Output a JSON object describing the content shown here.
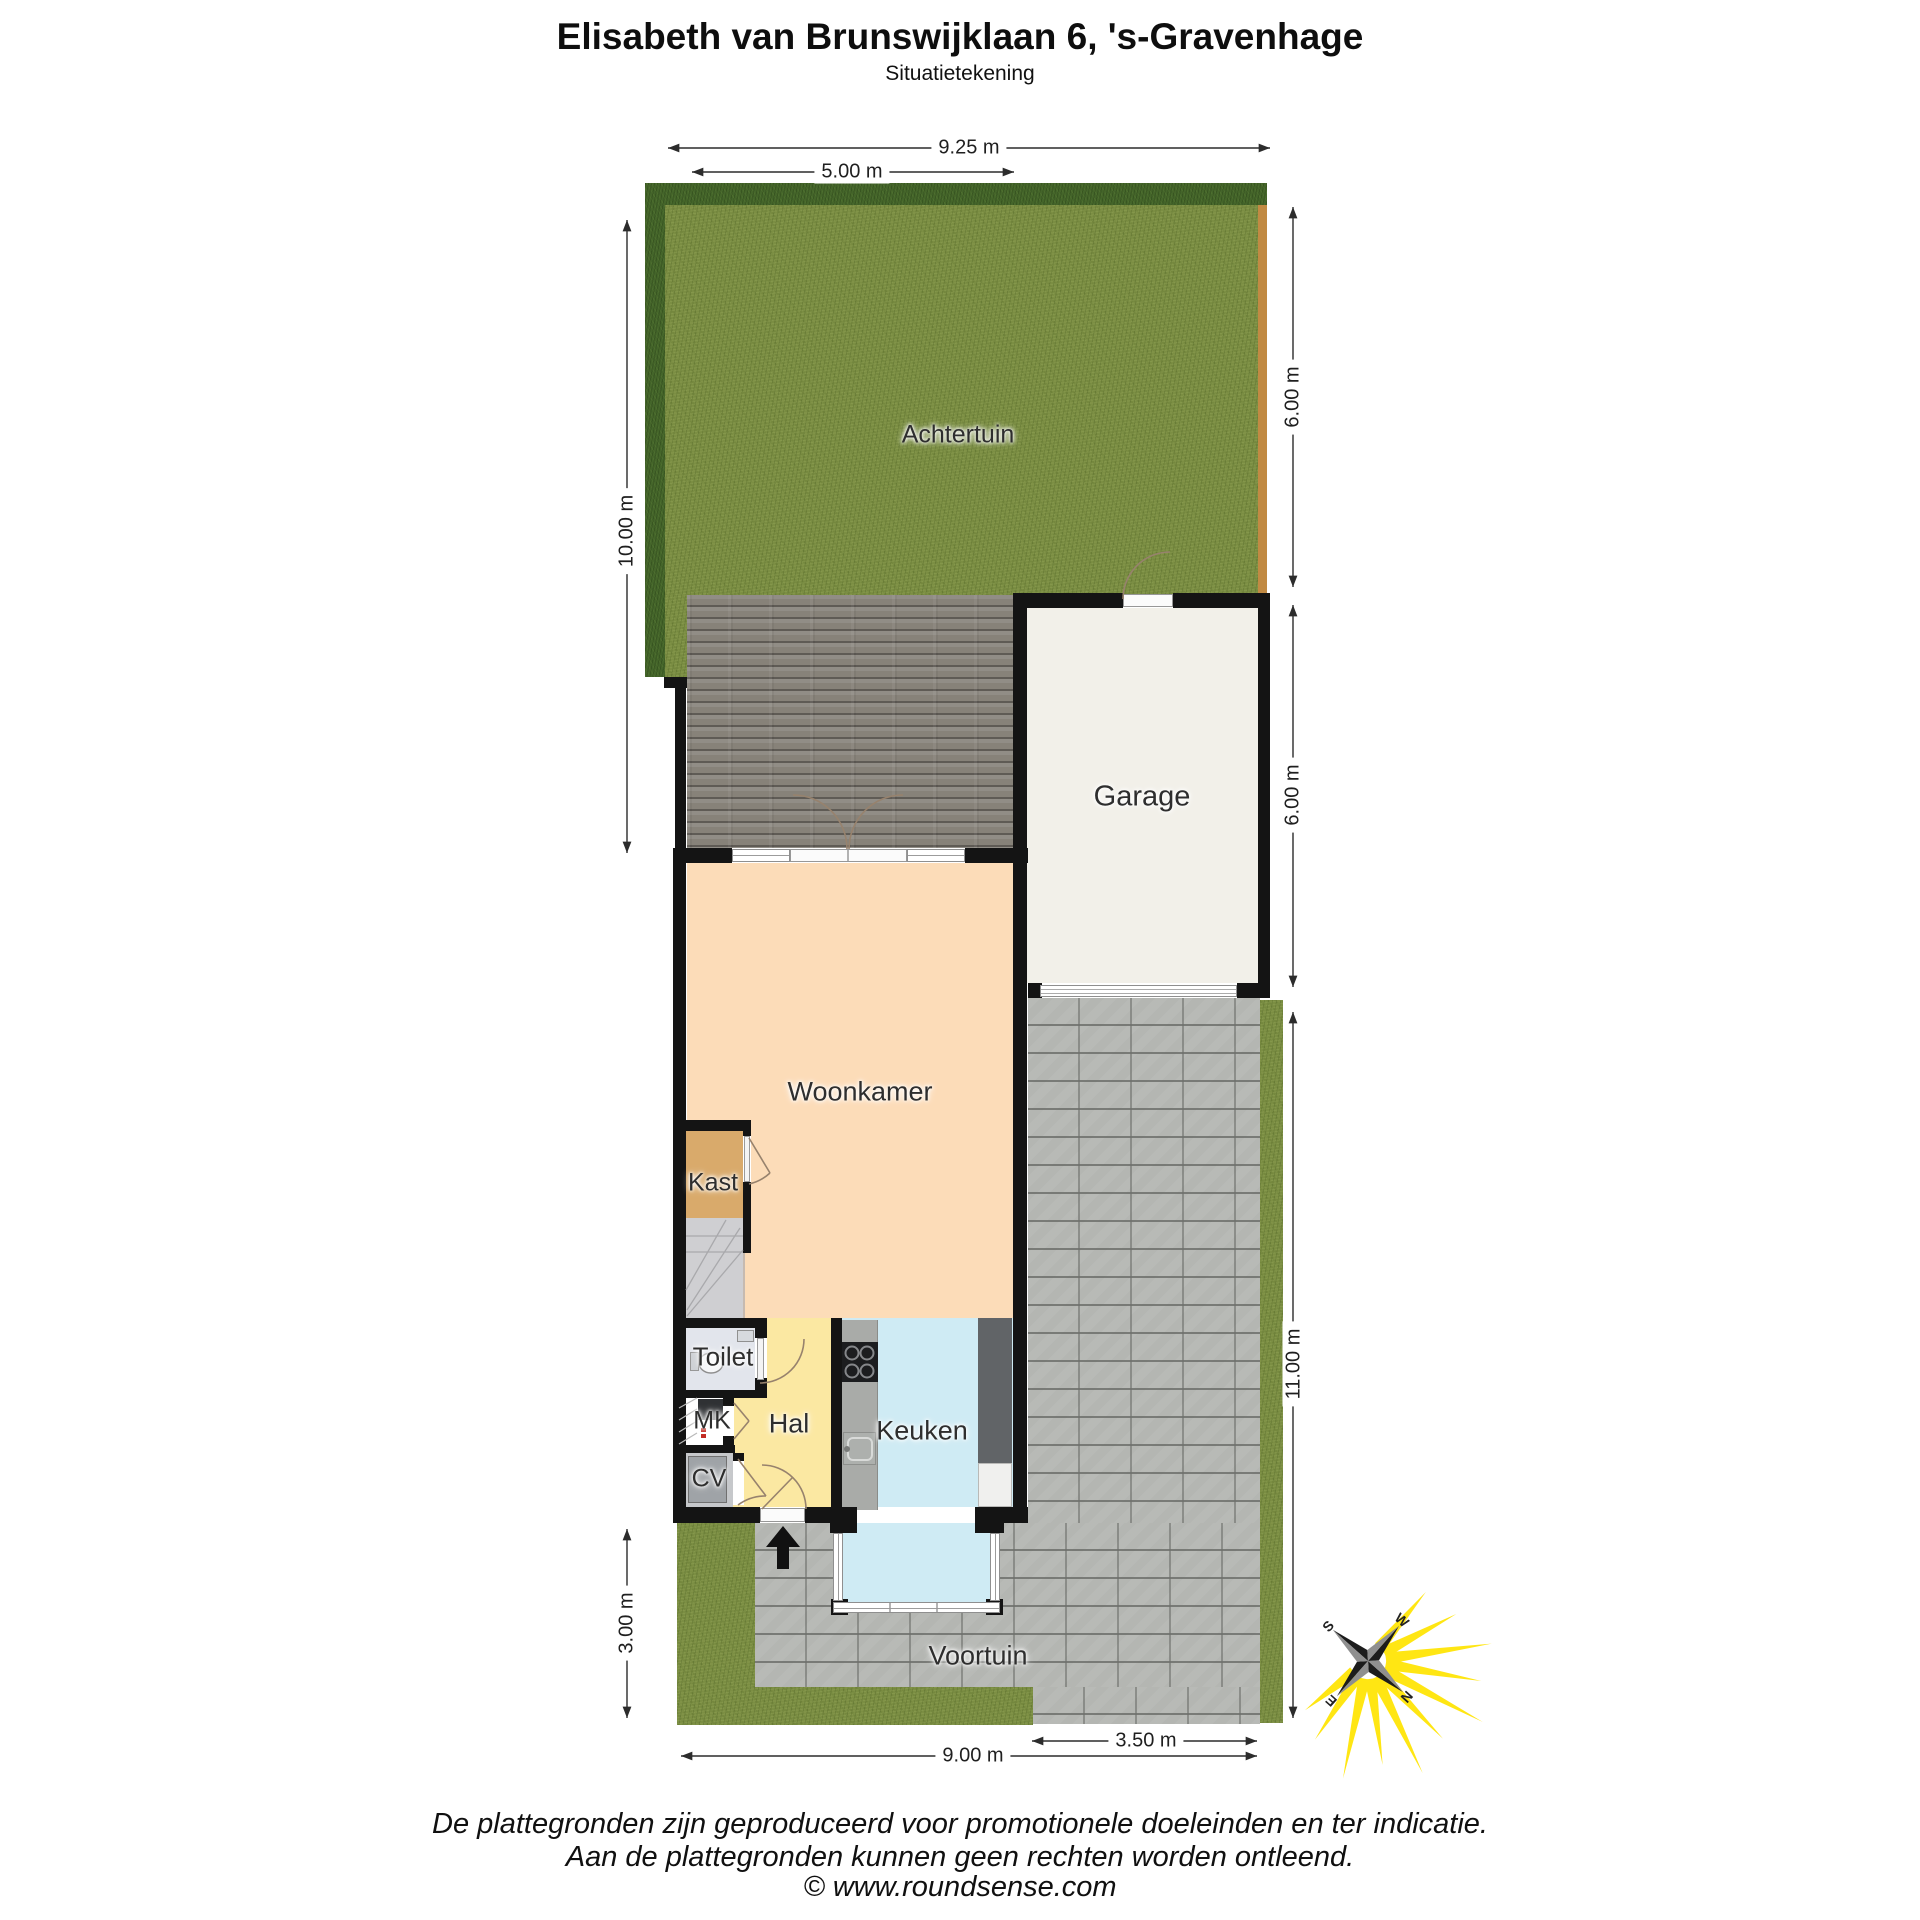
{
  "header": {
    "title": "Elisabeth van Brunswijklaan 6, 's-Gravenhage",
    "subtitle": "Situatietekening"
  },
  "plan": {
    "rooms": {
      "achtertuin": "Achtertuin",
      "garage": "Garage",
      "woonkamer": "Woonkamer",
      "kast": "Kast",
      "toilet": "Toilet",
      "mk": "MK",
      "hal": "Hal",
      "cv": "CV",
      "keuken": "Keuken",
      "voortuin": "Voortuin"
    },
    "dimensions": {
      "plot_width": "9.25 m",
      "rear_facade_width": "5.00 m",
      "left_depth": "10.00 m",
      "back_garden_depth": "6.00 m",
      "garage_depth": "6.00 m",
      "right_side_depth": "11.00 m",
      "front_garden_depth": "3.00 m",
      "front_width": "9.00 m",
      "driveway_width": "3.50 m"
    },
    "compass": {
      "north": "N",
      "east": "E",
      "south": "S",
      "west": "W"
    }
  },
  "footer": {
    "line1": "De plattegronden zijn geproduceerd voor promotionele doeleinden en ter indicatie.",
    "line2": "Aan de plattegronden kunnen geen rechten worden ontleend.",
    "line3": "© www.roundsense.com"
  },
  "colors": {
    "wall": "#141414",
    "grass": "#7b8e43",
    "hedge": "#44652a",
    "fence": "#c18a43",
    "deck": "#878279",
    "pavement": "#b4b6b2",
    "garage_floor": "#f2f0e9",
    "living_room": "#fcdcb8",
    "closet": "#d9aa6b",
    "hall": "#fbe8a2",
    "kitchen": "#cfebf4",
    "toilet": "#e2e5ec",
    "boiler_room": "#c6c8cb",
    "stairs": "#cfcfd2",
    "compass_ray": "#ffe400",
    "dimension_line": "#2c2c2c"
  }
}
